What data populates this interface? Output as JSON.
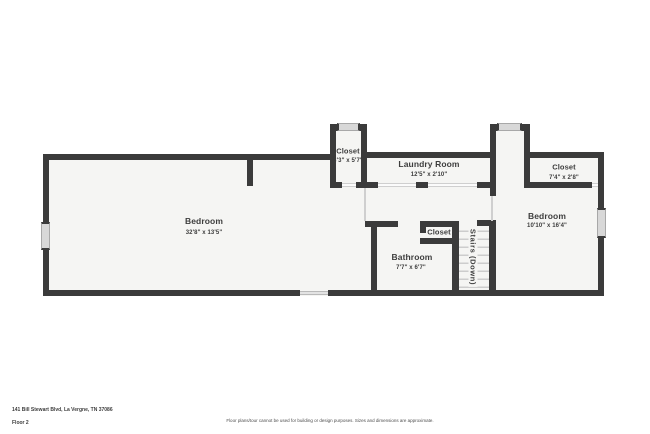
{
  "floorplan": {
    "rooms": {
      "bedroom_left": {
        "name": "Bedroom",
        "dims": "32'8\" x 13'5\""
      },
      "closet_top": {
        "name": "Closet",
        "dims": "3'3\" x 5'7\""
      },
      "laundry": {
        "name": "Laundry Room",
        "dims": "12'5\" x 2'10\""
      },
      "closet_right": {
        "name": "Closet",
        "dims": "7'4\" x 2'8\""
      },
      "bedroom_right": {
        "name": "Bedroom",
        "dims": "10'10\" x 16'4\""
      },
      "closet_small": {
        "name": "Closet"
      },
      "bathroom": {
        "name": "Bathroom",
        "dims": "7'7\" x 6'7\""
      },
      "stairs": {
        "name": "Stairs (Down)"
      }
    }
  },
  "footer": {
    "address": "141 Bill Stewart Blvd, La Vergne, TN 37086",
    "floor_label": "Floor 2",
    "disclaimer": "Floor plans/tour cannot be used for building or design purposes. Sizes and dimensions are approximate."
  },
  "colors": {
    "wall": "#3b3b3b",
    "floor": "#f5f5f3",
    "window": "#d8d8d8",
    "text": "#3d3d3d",
    "background": "#ffffff"
  }
}
